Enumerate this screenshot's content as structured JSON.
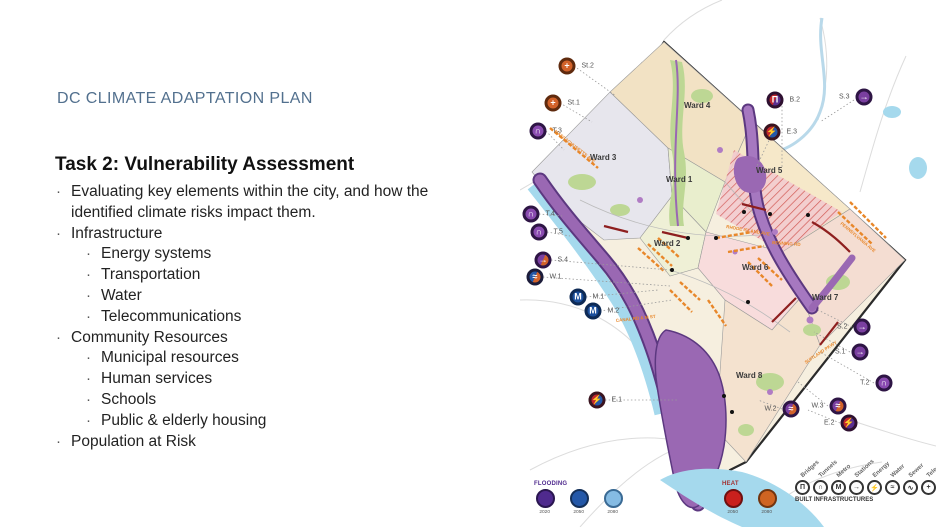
{
  "slide": {
    "title": "DC CLIMATE ADAPTATION PLAN",
    "heading": "Task 2: Vulnerability Assessment",
    "bullets": [
      {
        "level": 1,
        "text": "Evaluating key elements within the city, and how the identified climate risks impact them."
      },
      {
        "level": 1,
        "text": "Infrastructure"
      },
      {
        "level": 2,
        "text": "Energy systems"
      },
      {
        "level": 2,
        "text": "Transportation"
      },
      {
        "level": 2,
        "text": "Water"
      },
      {
        "level": 2,
        "text": "Telecommunications"
      },
      {
        "level": 1,
        "text": "Community Resources"
      },
      {
        "level": 2,
        "text": "Municipal resources"
      },
      {
        "level": 2,
        "text": "Human services"
      },
      {
        "level": 2,
        "text": "Schools"
      },
      {
        "level": 2,
        "text": "Public & elderly housing"
      },
      {
        "level": 1,
        "text": "Population at Risk"
      }
    ]
  },
  "map": {
    "wards": [
      {
        "label": "Ward 1"
      },
      {
        "label": "Ward 2"
      },
      {
        "label": "Ward 3"
      },
      {
        "label": "Ward 4"
      },
      {
        "label": "Ward 5"
      },
      {
        "label": "Ward 6"
      },
      {
        "label": "Ward 7"
      },
      {
        "label": "Ward 8"
      }
    ],
    "markers": [
      {
        "label": "St.2",
        "icon": "streets-icon",
        "glyph": "+"
      },
      {
        "label": "St.1",
        "icon": "streets-icon",
        "glyph": "+"
      },
      {
        "label": "T.3",
        "icon": "tunnel-icon",
        "glyph": "∩"
      },
      {
        "label": "T.4",
        "icon": "tunnel-icon",
        "glyph": "∩"
      },
      {
        "label": "T.5",
        "icon": "tunnel-icon",
        "glyph": "∩"
      },
      {
        "label": "S.4",
        "icon": "station-icon",
        "glyph": "→"
      },
      {
        "label": "W.1",
        "icon": "water-icon",
        "glyph": "≈"
      },
      {
        "label": "M.1",
        "icon": "metro-icon",
        "glyph": "M"
      },
      {
        "label": "M.2",
        "icon": "metro-icon",
        "glyph": "M"
      },
      {
        "label": "E.1",
        "icon": "energy-icon",
        "glyph": "⚡"
      },
      {
        "label": "B.2",
        "icon": "bridge-icon",
        "glyph": "Π"
      },
      {
        "label": "E.3",
        "icon": "energy-icon",
        "glyph": "⚡"
      },
      {
        "label": "S.3",
        "icon": "station-icon",
        "glyph": "→"
      },
      {
        "label": "S.2",
        "icon": "station-icon",
        "glyph": "→"
      },
      {
        "label": "S.1",
        "icon": "station-icon",
        "glyph": "→"
      },
      {
        "label": "T.2",
        "icon": "tunnel-icon",
        "glyph": "∩"
      },
      {
        "label": "W.3",
        "icon": "water-icon",
        "glyph": "≈"
      },
      {
        "label": "W.2",
        "icon": "water-icon",
        "glyph": "≈"
      },
      {
        "label": "E.2",
        "icon": "energy-icon",
        "glyph": "⚡"
      }
    ],
    "annotations": [
      "MASSACHUSETTS AVE",
      "CANAL RD & M ST",
      "RHODE ISLAND AVE",
      "BENNING RD",
      "PENNSYLVANIA AVE",
      "SUITLAND PKWY"
    ],
    "legend": {
      "flooding": {
        "title": "FLOODING",
        "items": [
          {
            "year": "2020",
            "color": "#4f2a8e"
          },
          {
            "year": "2050",
            "color": "#2458a8"
          },
          {
            "year": "2080",
            "color": "#85bbe3"
          }
        ]
      },
      "heat": {
        "title": "HEAT",
        "items": [
          {
            "year": "2050",
            "color": "#c9201d"
          },
          {
            "year": "2080",
            "color": "#cf6422"
          }
        ]
      },
      "infrastructure": {
        "title": "BUILT INFRASTRUCTURES",
        "icons": [
          {
            "name": "bridges-icon",
            "label": "Bridges",
            "glyph": "Π"
          },
          {
            "name": "tunnels-icon",
            "label": "Tunnels",
            "glyph": "∩"
          },
          {
            "name": "metro-icon",
            "label": "Metro",
            "glyph": "M"
          },
          {
            "name": "stations-icon",
            "label": "Stations",
            "glyph": "→"
          },
          {
            "name": "energy-icon",
            "label": "Energy",
            "glyph": "⚡"
          },
          {
            "name": "water-icon",
            "label": "Water",
            "glyph": "≈"
          },
          {
            "name": "sewer-icon",
            "label": "Sewer",
            "glyph": "∿"
          },
          {
            "name": "telecom-icon",
            "label": "Telecom",
            "glyph": "+"
          }
        ],
        "lines": [
          {
            "name": "streets-line",
            "label": "Streets",
            "color": "#e8872a"
          },
          {
            "name": "railways-line",
            "label": "Railways",
            "color": "#a32626"
          },
          {
            "name": "roads-line",
            "label": "Roads",
            "color": "#8a8a8a"
          }
        ]
      }
    }
  }
}
